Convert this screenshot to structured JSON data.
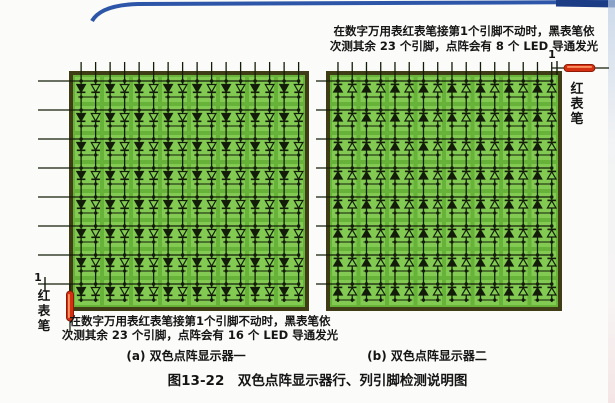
{
  "figure": {
    "caption": "图13-22　双色点阵显示器行、列引脚检测说明图",
    "sub_captions": {
      "a": "(a) 双色点阵显示器一",
      "b": "(b) 双色点阵显示器二"
    }
  },
  "annotations": {
    "top_right": {
      "line1": "在数字万用表红表笔接第1个引脚不动时，黑表笔依",
      "line2": "次测其余 23 个引脚，点阵会有 8 个 LED 导通发光"
    },
    "bottom_left": {
      "line1": "在数字万用表红表笔接第1个引脚不动时，黑表笔依",
      "line2": "次测其余 23 个引脚，点阵会有 16 个 LED 导通发光"
    }
  },
  "matrices": [
    {
      "name": "双色点阵显示器一",
      "rows": 8,
      "cols": 8,
      "leds_per_cell": 2,
      "diode_direction": "down",
      "probe": {
        "pin": "1",
        "label": "红表笔",
        "position": "bottom-left",
        "orientation": "vertical"
      }
    },
    {
      "name": "双色点阵显示器二",
      "rows": 8,
      "cols": 8,
      "leds_per_cell": 2,
      "diode_direction": "up",
      "probe": {
        "pin": "1",
        "label": "红表笔",
        "position": "top-right",
        "orientation": "horizontal"
      }
    }
  ],
  "colors": {
    "board_green": "#67b33a",
    "cell_green": "#82ca52",
    "board_border": "#3f3d15",
    "wire": "#131c09",
    "probe_red": "#d42f10",
    "probe_dark": "#7a1402",
    "probe_highlight": "#ff9f6a",
    "text": "#151515",
    "edge_blue": "#2d56a8"
  }
}
